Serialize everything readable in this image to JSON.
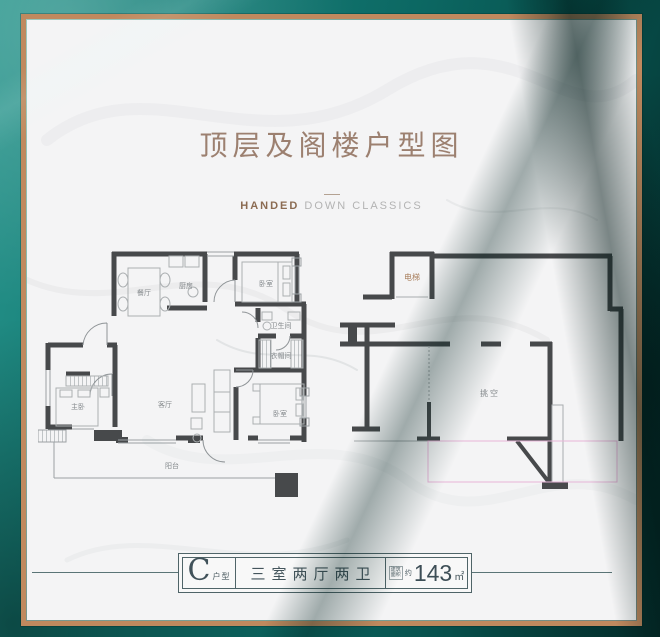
{
  "header": {
    "title": "顶层及阁楼户型图",
    "subtitle_bold": "HANDED",
    "subtitle_rest": " DOWN CLASSICS"
  },
  "plan_main": {
    "rooms": {
      "dining": "餐厅",
      "kitchen": "厨房",
      "bedroom_top": "卧室",
      "bathroom": "卫生间",
      "cloakroom": "衣帽间",
      "master_bedroom": "主卧",
      "living": "客厅",
      "bedroom_right": "卧室",
      "balcony": "阳台"
    }
  },
  "plan_attic": {
    "rooms": {
      "elevator": "电梯",
      "void": "挑空"
    }
  },
  "footer": {
    "type_letter": "C",
    "type_label": "户型",
    "layout_text": "三室两厅两卫",
    "area_label_line1": "建筑",
    "area_label_line2": "面积",
    "area_approx": "约",
    "area_value": "143",
    "area_unit": "㎡"
  },
  "colors": {
    "teal_background": "#0c6762",
    "copper_frame": "#c0895e",
    "wall": "#47494b",
    "title_text": "#9c8070",
    "elevator_label": "#aa8160",
    "pink_outline": "#e7b5d8"
  }
}
